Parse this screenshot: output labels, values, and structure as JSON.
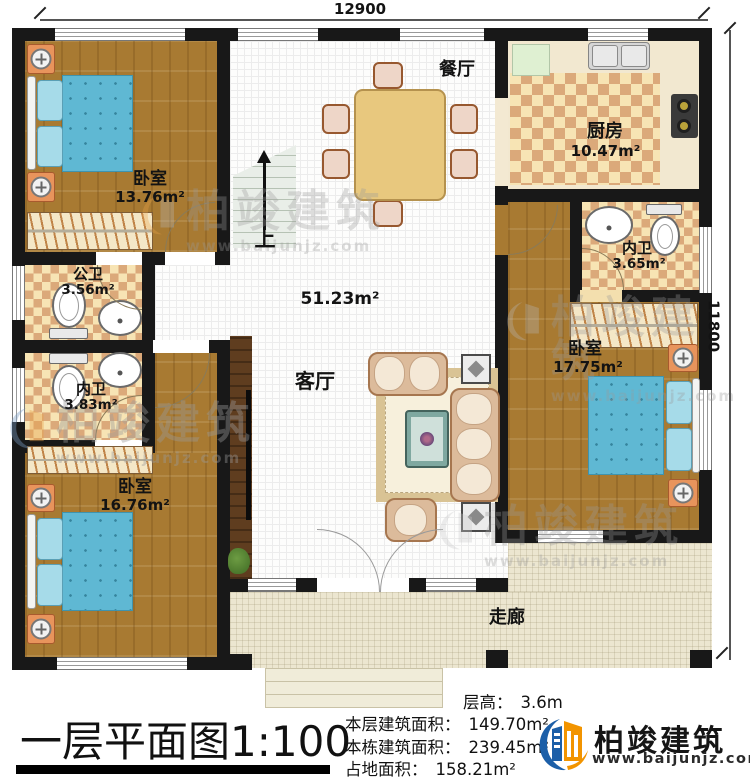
{
  "dimensions": {
    "top": "12900",
    "right": "11800"
  },
  "rooms": {
    "bedroom_tl": {
      "name": "卧室",
      "area": "13.76m²"
    },
    "dining": {
      "name": "餐厅"
    },
    "kitchen": {
      "name": "厨房",
      "area": "10.47m²"
    },
    "bath_public": {
      "name": "公卫",
      "area": "3.56m²"
    },
    "bath_inner_left": {
      "name": "内卫",
      "area": "3.83m²"
    },
    "bath_inner_right": {
      "name": "内卫",
      "area": "3.65m²"
    },
    "bedroom_right": {
      "name": "卧室",
      "area": "17.75m²"
    },
    "bedroom_bl": {
      "name": "卧室",
      "area": "16.76m²"
    },
    "living": {
      "name": "客厅",
      "area": "51.23m²"
    },
    "corridor": {
      "name": "走廊"
    },
    "stairs": {
      "label": "上"
    }
  },
  "caption": {
    "title": "一层平面图1:100",
    "stats": [
      {
        "label": "层高：",
        "value": "3.6m"
      },
      {
        "label": "本层建筑面积：",
        "value": "149.70m²"
      },
      {
        "label": "本栋建筑面积：",
        "value": "239.45m²"
      },
      {
        "label": "占地面积：",
        "value": "158.21m²"
      }
    ]
  },
  "logo": {
    "name": "柏竣建筑",
    "url": "www.baijunjz.com"
  },
  "watermark": {
    "text": "柏竣建筑",
    "url": "www.baijunjz.com"
  },
  "colors": {
    "wall": "#181818",
    "wood_floor": "#a87a32",
    "tile_light": "#f7e4b4",
    "tile_dark": "#dba97a",
    "corridor": "#ece6d0",
    "bed_blue": "#5fb8d3",
    "nightstand_orange": "#e8945c",
    "logo_blue": "#1c5fa8",
    "logo_orange": "#f29400"
  }
}
